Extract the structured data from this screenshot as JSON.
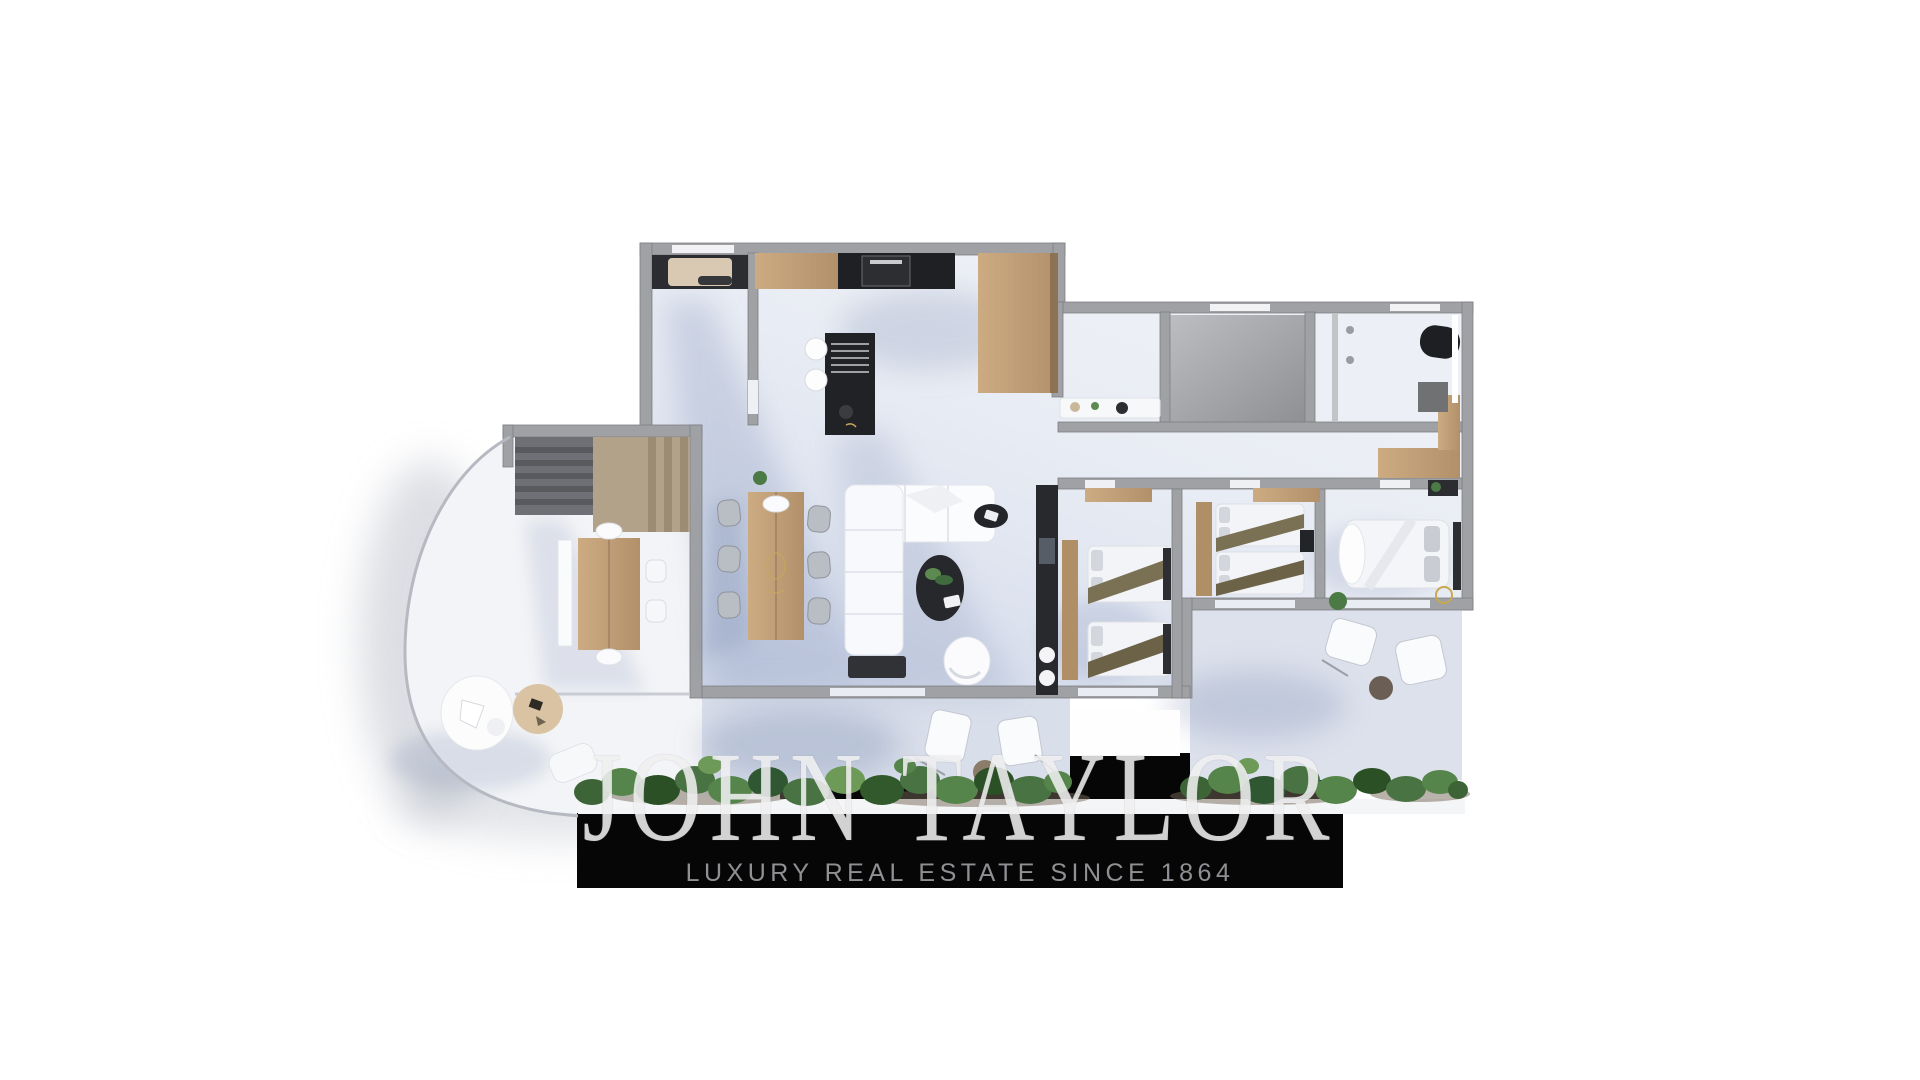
{
  "watermark": {
    "brand": "JOHN TAYLOR",
    "tagline": "LUXURY REAL ESTATE SINCE 1864",
    "band_color": "#060606",
    "brand_color": "rgba(255,255,255,0.78)",
    "tagline_color": "#909094"
  },
  "scene": {
    "type": "3d-floor-plan-render",
    "background": "#ffffff",
    "description_elements": [
      "kitchen-island",
      "kitchen-cabinets",
      "cooktop",
      "entrance-utility-room",
      "staircase",
      "study-table",
      "dining-table",
      "l-shaped-sofa",
      "coffee-table",
      "tv-wall",
      "twin-bedroom-1",
      "twin-bedroom-2",
      "master-bedroom",
      "bathroom",
      "bathtub",
      "walk-in-closet",
      "hallway-console",
      "curved-terrace",
      "round-daybed",
      "side-table",
      "outdoor-chairs",
      "garden-planter"
    ]
  },
  "palette": {
    "wall": "#a0a1a5",
    "wall_edge": "#7e7f83",
    "floor": "#eceff5",
    "terrace_floor": "#d8deea",
    "wood": "#c4a27b",
    "black_furniture": "#202225",
    "plant_green": "#3c6436",
    "accent_gold": "#c8a850",
    "olive_textile": "#7a7154",
    "shadow_blue": "rgba(110,130,175,0.22)"
  }
}
